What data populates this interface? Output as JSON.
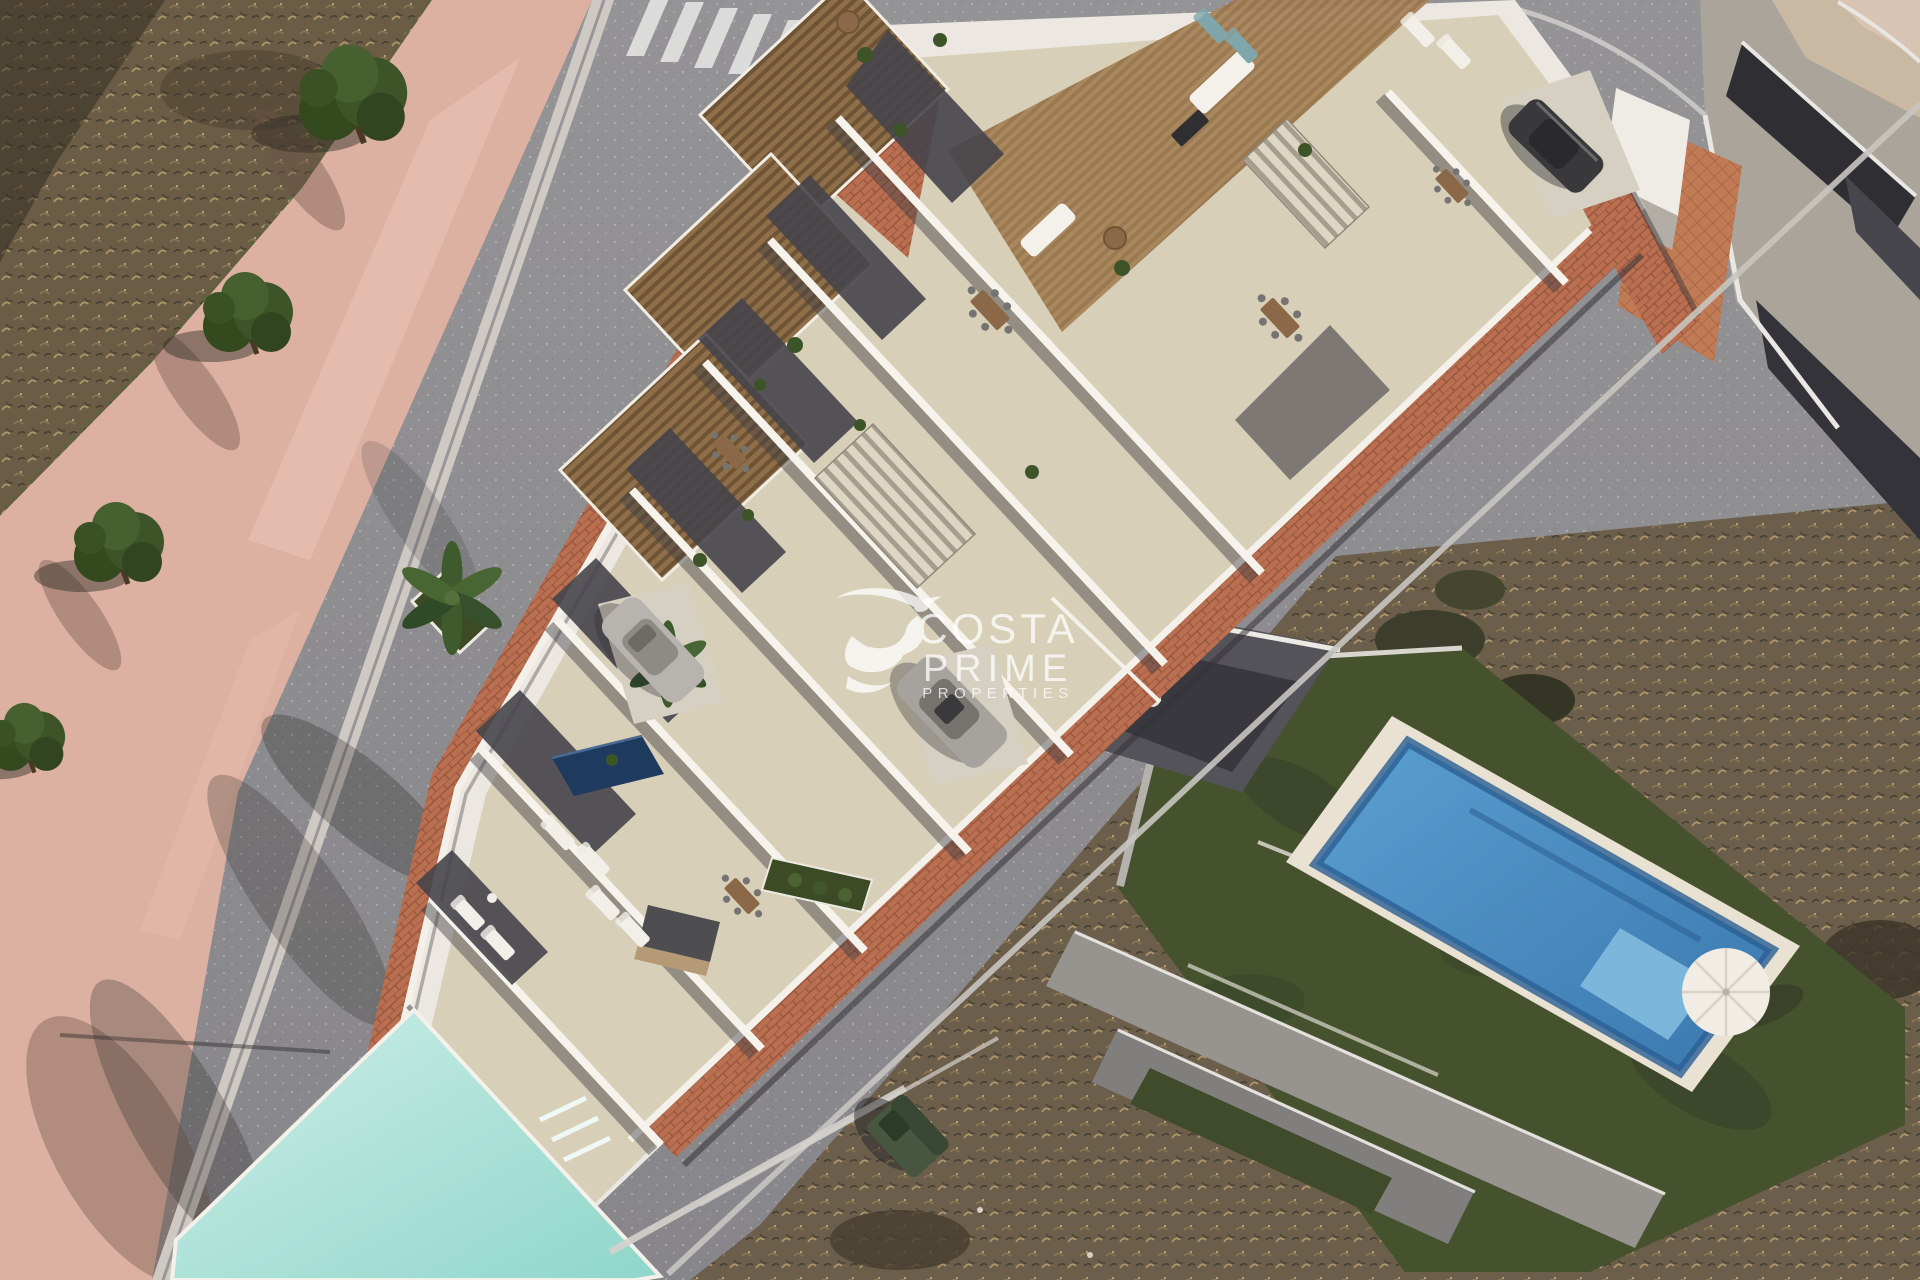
{
  "image": {
    "kind": "aerial-3d-architectural-render",
    "description": "Bird's-eye 3D render of a new development of white Mediterranean townhouses with stepped roof terraces, wooden pergolas, private driveways and a communal pool, set on a wedge-shaped plot between two diagonal streets; a zebra crossing and tree-lined pink footpath sit to the left, dry scrubland plots and an existing villa with artificial lawn, private blue pool and parasol sit to the right.",
    "width_px": 1920,
    "height_px": 1280
  },
  "watermark": {
    "logo": "hummingbird-icon",
    "line1": "COSTA",
    "line2": "PRIME",
    "line3": "PROPERTIES",
    "color": "#ffffff",
    "opacity": 0.75
  },
  "palette": {
    "asphalt": "#8e8d90",
    "footpath_pink": "#ddb1a2",
    "curb_light": "#cfc9c4",
    "paver_terracotta": "#b96f50",
    "building_white": "#ece8e1",
    "terrace_stone": "#d7cdb7",
    "pergola_wood": "#8a6a45",
    "wall_shadow": "#46454b",
    "communal_pool_aqua": "#a9e0d6",
    "private_pool_blue": "#3f7fb5",
    "plunge_pool_navy": "#1e3a5f",
    "lawn_green": "#45522d",
    "scrub_brown": "#6b5c46",
    "tree_green": "#3d5429",
    "crosswalk_white": "#e2e2e0",
    "existing_roof_gray": "#aaa49b",
    "roof_patch_dark": "#2f2e32",
    "roof_tiles_orange": "#c07a54"
  },
  "scene": {
    "objects": [
      {
        "id": "left-street",
        "label": "Asphalt street (left)"
      },
      {
        "id": "right-street",
        "label": "Asphalt street (right)"
      },
      {
        "id": "zebra-crossing",
        "label": "Pedestrian zebra crossing"
      },
      {
        "id": "pink-footpath",
        "label": "Pink pedestrian footpath"
      },
      {
        "id": "street-trees",
        "label": "Round street trees"
      },
      {
        "id": "scrubland-left",
        "label": "Dry scrubland plot (top left)"
      },
      {
        "id": "scrubland-right",
        "label": "Dry scrubland plot (bottom right)"
      },
      {
        "id": "townhouse-block",
        "label": "New white townhouse block"
      },
      {
        "id": "roof-terraces",
        "label": "Stone roof terraces"
      },
      {
        "id": "wood-pergolas",
        "label": "Wooden pergola roofs"
      },
      {
        "id": "staircases",
        "label": "External staircases"
      },
      {
        "id": "terracotta-pavement",
        "label": "Terracotta paver sidewalks"
      },
      {
        "id": "silver-car-1",
        "label": "Parked silver car"
      },
      {
        "id": "silver-car-2",
        "label": "Parked silver car"
      },
      {
        "id": "dark-car",
        "label": "Parked dark car"
      },
      {
        "id": "plunge-pool",
        "label": "Private plunge pool"
      },
      {
        "id": "palm-trees",
        "label": "Palm trees"
      },
      {
        "id": "communal-pool",
        "label": "Communal swimming pool"
      },
      {
        "id": "sun-loungers",
        "label": "Sun loungers"
      },
      {
        "id": "dining-sets",
        "label": "Outdoor dining sets"
      },
      {
        "id": "waste-container",
        "label": "Street waste container"
      },
      {
        "id": "existing-rooftops",
        "label": "Existing building rooftops"
      },
      {
        "id": "rooftop-tiled-patio",
        "label": "Tiled rooftop patio"
      },
      {
        "id": "villa-lawn",
        "label": "Villa artificial lawn"
      },
      {
        "id": "private-pool",
        "label": "Private blue pool"
      },
      {
        "id": "parasol",
        "label": "White parasol"
      },
      {
        "id": "retaining-walls",
        "label": "Gray retaining walls"
      }
    ]
  }
}
